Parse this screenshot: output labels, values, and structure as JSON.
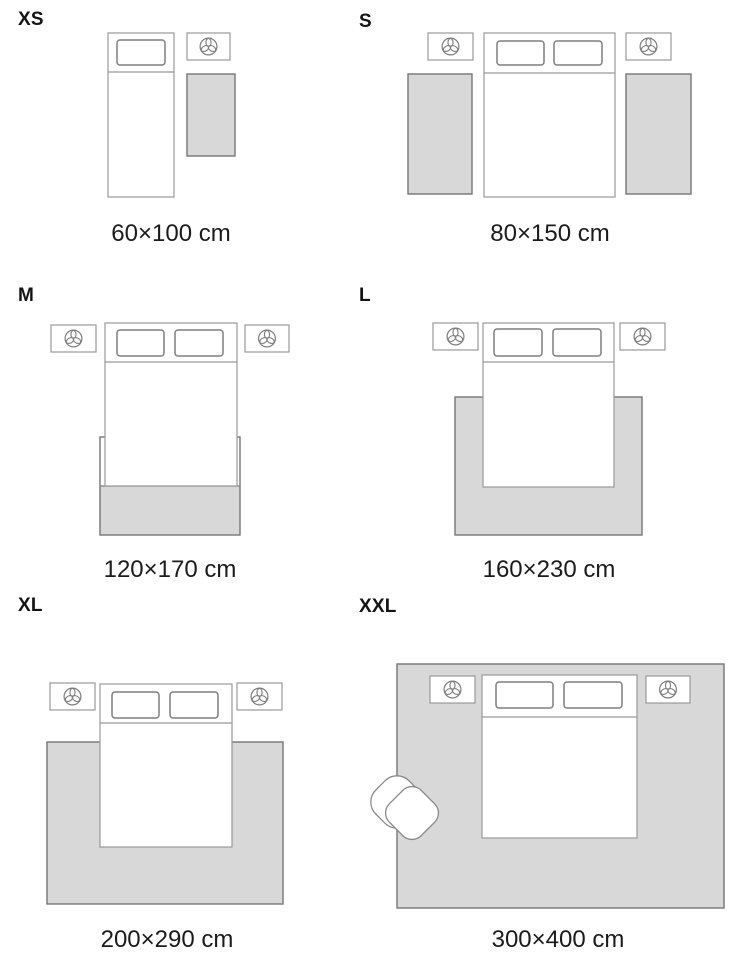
{
  "guide": {
    "kind": "rug-size-guide",
    "sizes": [
      {
        "id": "xs",
        "label": "XS",
        "dimensions": "60×100 cm"
      },
      {
        "id": "s",
        "label": "S",
        "dimensions": "80×150 cm"
      },
      {
        "id": "m",
        "label": "M",
        "dimensions": "120×170 cm"
      },
      {
        "id": "l",
        "label": "L",
        "dimensions": "160×230 cm"
      },
      {
        "id": "xl",
        "label": "XL",
        "dimensions": "200×290 cm"
      },
      {
        "id": "xxl",
        "label": "XXL",
        "dimensions": "300×400 cm"
      }
    ]
  },
  "icons": {
    "plant_icon": "trefoil-plant-in-circle",
    "bed_icon": "bed-top-view",
    "nightstand_icon": "nightstand-top-view",
    "armchair_icon": "armchair-top-view",
    "rug_icon": "rug-rectangle"
  },
  "colors": {
    "background": "#ffffff",
    "rug_fill": "#d8d8d8",
    "rug_stroke": "#767676",
    "furniture_stroke": "#9a9a9a",
    "detail_stroke": "#7f7f7f",
    "text": "#1b1b1b"
  }
}
